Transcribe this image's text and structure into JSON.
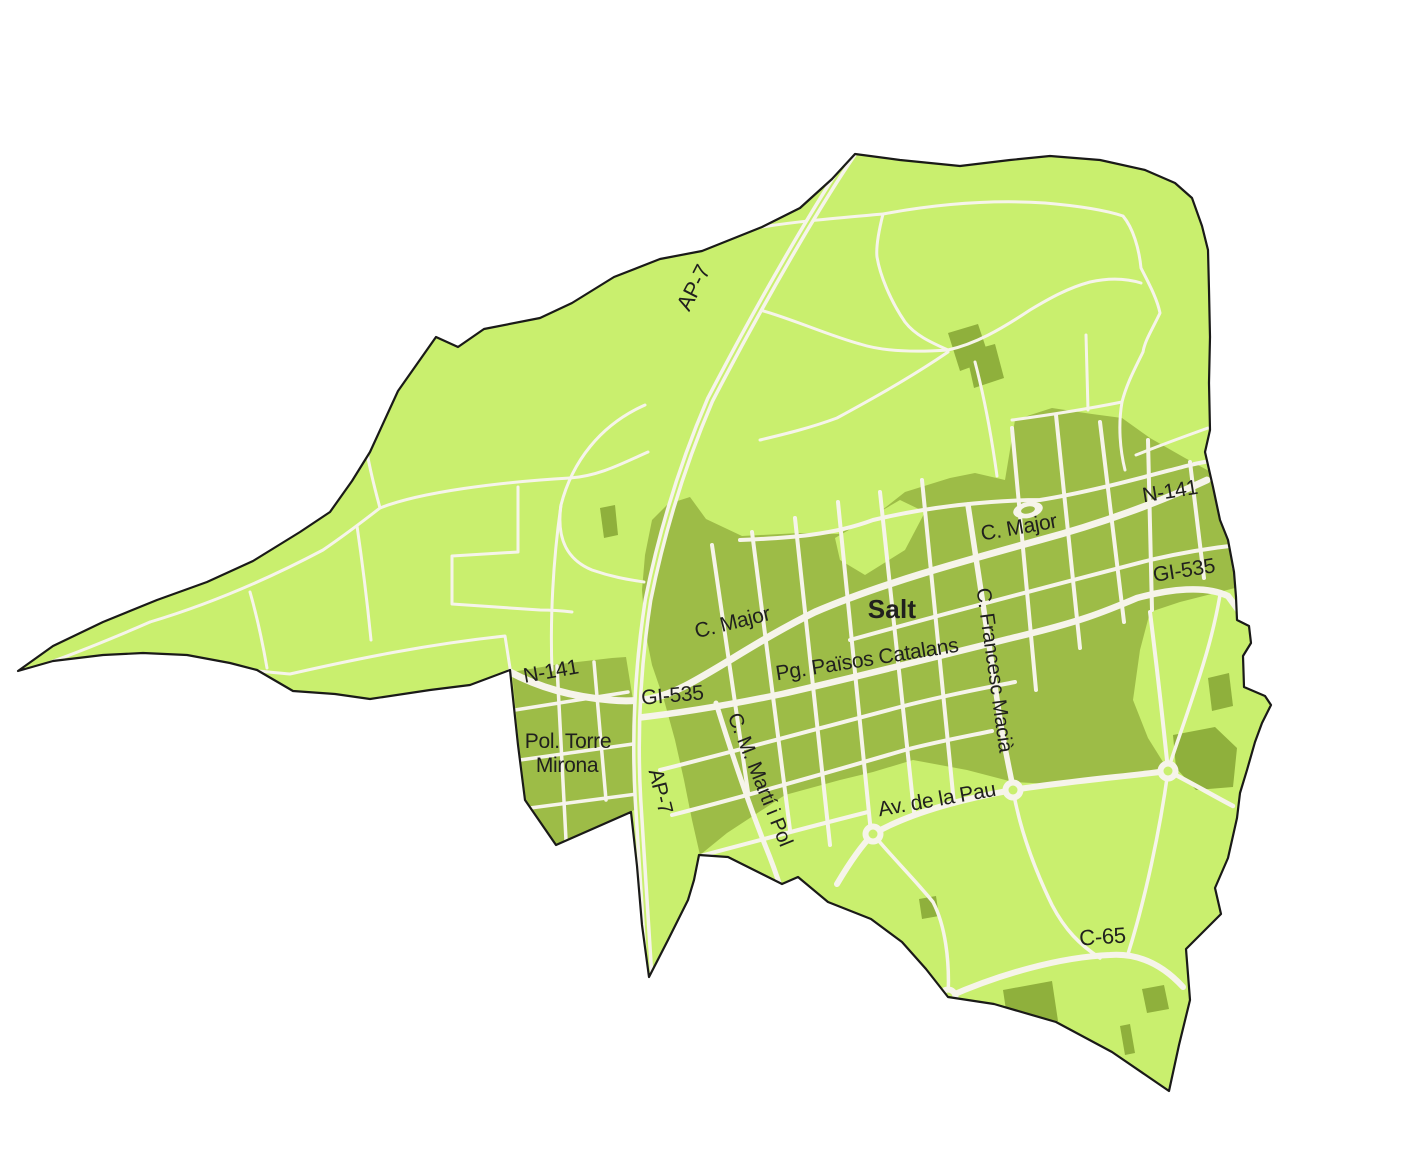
{
  "map": {
    "region_name": "Salt",
    "labels": {
      "ap7_north": "AP-7",
      "ap7_south": "AP-7",
      "n141_west": "N-141",
      "n141_east": "N-141",
      "gi535_west": "GI-535",
      "gi535_east": "GI-535",
      "c_major_west": "C. Major",
      "c_major_east": "C. Major",
      "town": "Salt",
      "pg_paisos": "Pg. Països Catalans",
      "francesc_macia": "C. Francesc Macià",
      "marti_pol": "C. M. Martí i Pol",
      "pol_torre_line1": "Pol. Torre",
      "pol_torre_line2": "Mirona",
      "av_pau": "Av. de la Pau",
      "c65": "C-65"
    },
    "palette": {
      "bg": "#ffffff",
      "land": "#c9ef6e",
      "urban": "#9dbc47",
      "building": "#8fb03c",
      "road": "#f6f4ea",
      "boundary": "#1a1a18",
      "label": "#20201e"
    }
  }
}
